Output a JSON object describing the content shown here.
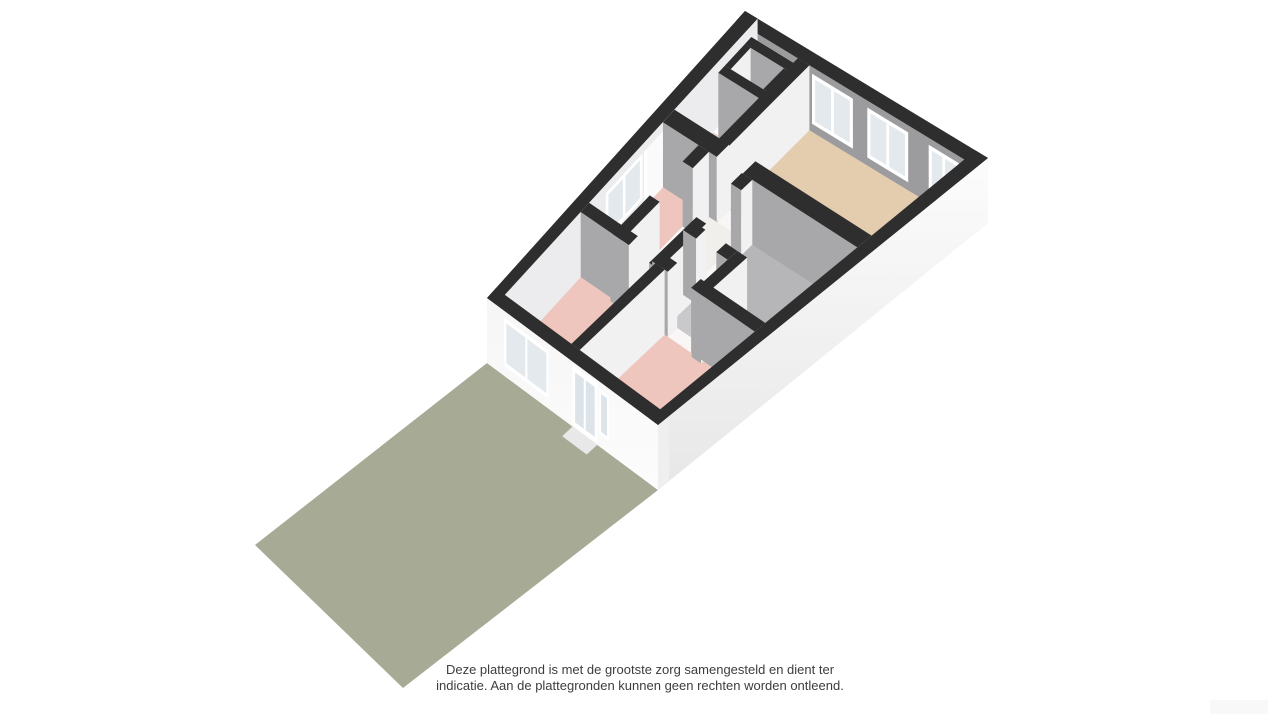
{
  "page": {
    "background": "#ffffff"
  },
  "disclaimer": {
    "line1": "Deze plattegrond is met de grootste zorg samengesteld en dient ter",
    "line2": "indicatie. Aan de plattegronden kunnen geen rechten worden ontleend."
  },
  "watermark": {
    "present": true
  },
  "palette": {
    "wall_top": "#2e2e2e",
    "wall_gray": "#9c9c9f",
    "wall_gray_int": "#a8a8ab",
    "wall_light": "#f1f1f2",
    "wall_light_nw": "#ececee",
    "ext_face_light": "#fcfcfc",
    "ext_face_shade": "#e7e7e8",
    "ext_sliver": "#efefef",
    "floor_living": "#e4cdae",
    "floor_bedroom": "#efc6bd",
    "floor_hall_pink": "#f0cfc7",
    "floor_bath": "#b6b6b8",
    "floor_toilet": "#c9c9cb",
    "floor_corridor": "#f1efec",
    "floor_closet": "#ededee",
    "threshold": "#f8f7f5",
    "window_frame": "#ffffff",
    "window_pane": "#e3e9ed",
    "door_glass": "#dde4e9",
    "door_step": "#e8e8e8",
    "garden": "#a7aa94",
    "text": "#3d3d3d"
  },
  "floorplan": {
    "type": "3d-floorplan-isometric",
    "view": "birds-eye-rotated",
    "rooms": [
      {
        "id": "living-room",
        "floor": "tan",
        "color_key": "floor_living"
      },
      {
        "id": "closet",
        "floor": "white",
        "color_key": "floor_closet"
      },
      {
        "id": "hall",
        "floor": "pink",
        "color_key": "floor_hall_pink"
      },
      {
        "id": "bedroom-3",
        "floor": "pink",
        "color_key": "floor_bedroom"
      },
      {
        "id": "corridor",
        "floor": "white",
        "color_key": "floor_corridor"
      },
      {
        "id": "bathroom",
        "floor": "gray",
        "color_key": "floor_bath"
      },
      {
        "id": "toilet",
        "floor": "gray",
        "color_key": "floor_toilet"
      },
      {
        "id": "bedroom-1",
        "floor": "pink",
        "color_key": "floor_bedroom"
      },
      {
        "id": "bedroom-2",
        "floor": "pink",
        "color_key": "floor_bedroom"
      }
    ],
    "windows": {
      "rear_wall": 4,
      "side_wall": 1,
      "front_wall": 1,
      "front_sidelight": 1
    },
    "doors": {
      "front_glass_door": 1,
      "interior_door_openings": 6
    },
    "garden": {
      "present": true,
      "color_key": "garden"
    }
  }
}
